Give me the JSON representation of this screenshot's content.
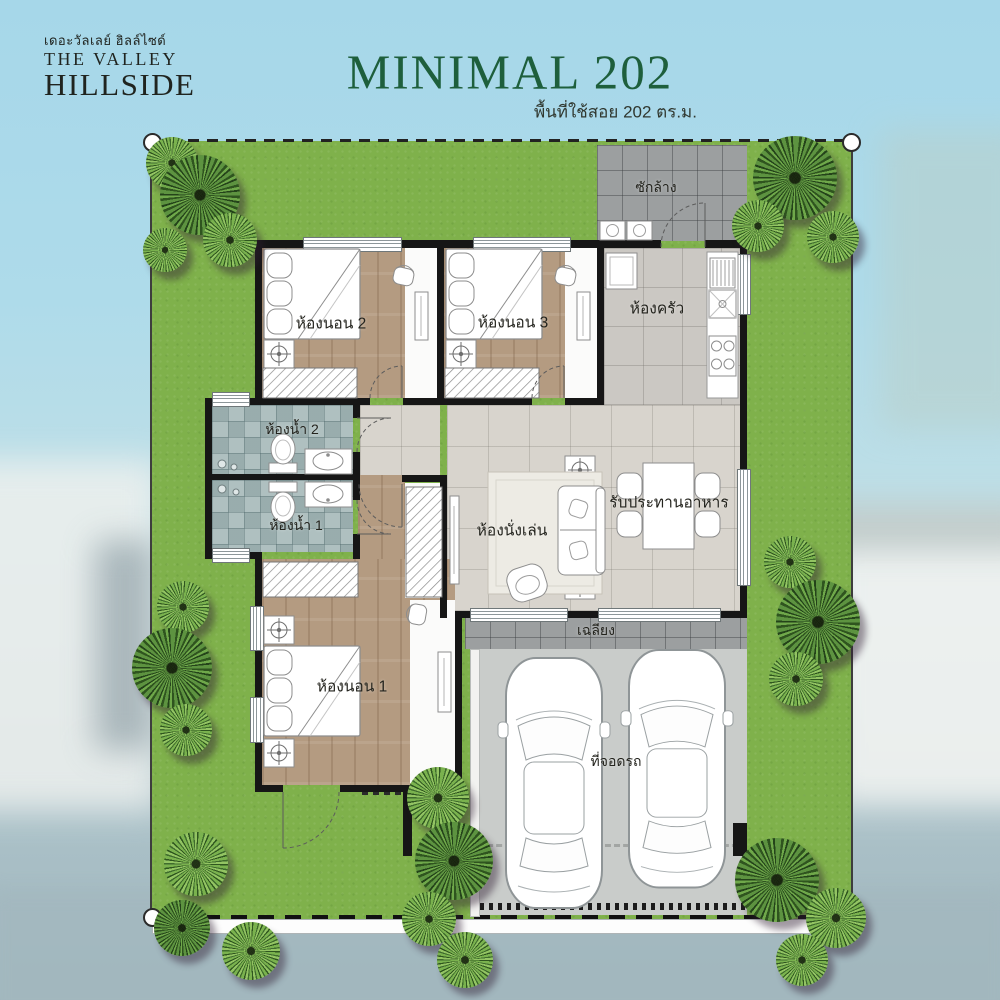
{
  "header": {
    "brand": {
      "thai_name": "เดอะวัลเลย์ ฮิลล์ไซด์",
      "name_line1": "THE VALLEY",
      "name_line2": "HILLSIDE"
    },
    "plan_title": "MINIMAL 202",
    "plan_subtitle": "พื้นที่ใช้สอย 202 ตร.ม."
  },
  "floor_plan": {
    "rooms": {
      "laundry": {
        "label": "ซักล้าง"
      },
      "bedroom2": {
        "label": "ห้องนอน 2"
      },
      "bedroom3": {
        "label": "ห้องนอน 3"
      },
      "kitchen": {
        "label": "ห้องครัว"
      },
      "bath2": {
        "label": "ห้องน้ำ 2"
      },
      "bath1": {
        "label": "ห้องน้ำ 1"
      },
      "living": {
        "label": "ห้องนั่งเล่น"
      },
      "dining": {
        "label": "รับประทานอาหาร"
      },
      "bedroom1": {
        "label": "ห้องนอน 1"
      },
      "terrace": {
        "label": "เฉลียง"
      },
      "parking": {
        "label": "ที่จอดรถ"
      }
    }
  },
  "colors": {
    "title_green": "#1e5f3c",
    "grass": "#7fb14b",
    "outdoor_tile": "#9c9fa0",
    "parking_gray": "#c9ccca",
    "wood_floor": "#b49b81",
    "bath_tile": "#a4b7b7"
  }
}
